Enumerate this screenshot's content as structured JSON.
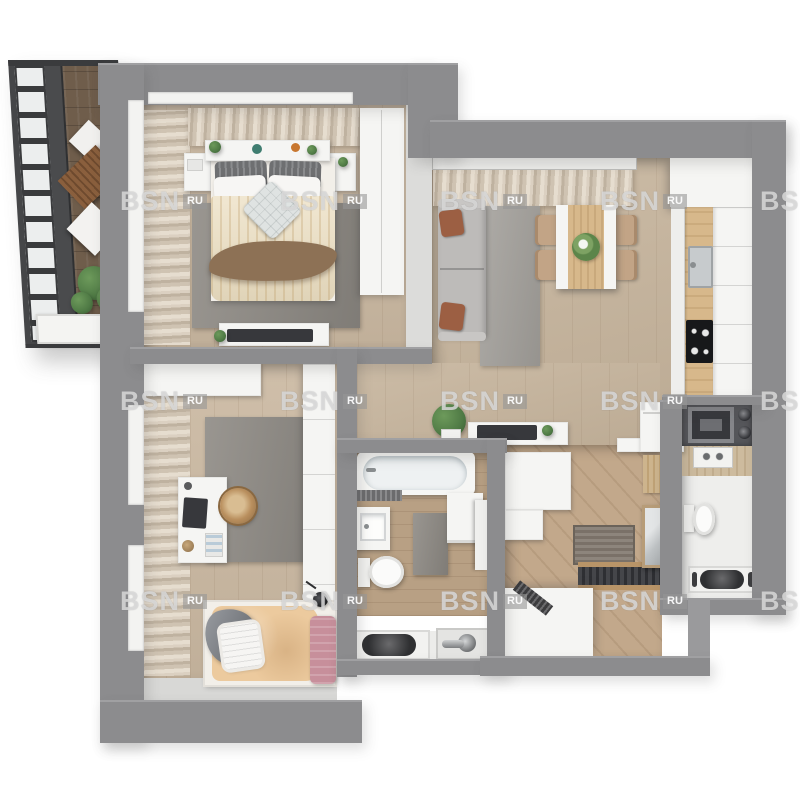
{
  "title": "apartment-3d-floor-plan-render",
  "watermark": {
    "brand": "BSN",
    "suffix": "RU",
    "columns_px": [
      120,
      280,
      440,
      600,
      760
    ],
    "rows_px": [
      188,
      388,
      588
    ]
  },
  "palette": {
    "wall": "#8c8c8e",
    "wallLight": "#a0a0a2",
    "dividerWhite": "#dcdcda",
    "balconyFrame": "#454648",
    "balconyDark": "#3a3b3d",
    "glass": "#eceeee",
    "deck": "#6f5d4b",
    "oakFloor": "#cbb9a2",
    "livingFloor": "#c6b49c",
    "hallFloor": "#c2a88b",
    "bathFloor": "#b8a084",
    "rug": "#8e8a84",
    "rugLight": "#a3a09b",
    "whiteFurn": "#f5f5f3",
    "counterWood": "#d7b88b",
    "darkCounter": "#55565a",
    "applianceDark": "#37383c",
    "sofa": "#bdbbb9",
    "accentRust": "#9c5f43",
    "chairTan": "#c2a486",
    "duvetCream": "#ecdfc2",
    "blanketBrown": "#8d7155",
    "kidsDuvet": "#ecca9e",
    "pinkBlanket": "#c78f9b",
    "plantGreen": "#4f7a45"
  },
  "rooms": [
    {
      "id": "balcony",
      "furniture": [
        "glazing",
        "wood-deck",
        "lounge-chair",
        "cushions",
        "plant",
        "planter-box"
      ]
    },
    {
      "id": "master-bedroom",
      "furniture": [
        "curtains",
        "headboard-shelf",
        "nightstands",
        "double-bed",
        "striped-pillows",
        "duvet",
        "throw-blanket",
        "area-rug",
        "wardrobe",
        "tv-stand",
        "tv"
      ]
    },
    {
      "id": "living-room-kitchen",
      "furniture": [
        "curtains",
        "sofa",
        "accent-pillows",
        "area-rug",
        "dining-table",
        "dining-chairs",
        "flower-bouquet",
        "upper-cabinets",
        "counter",
        "sink",
        "cooktop",
        "tall-cabinets"
      ]
    },
    {
      "id": "kids-bedroom",
      "furniture": [
        "curtains",
        "storage-cabinet",
        "area-rug",
        "desk",
        "laptop",
        "rattan-chair",
        "single-bed",
        "pillow",
        "duvet",
        "pink-blanket",
        "clothes",
        "wardrobe",
        "pendant-lamp"
      ]
    },
    {
      "id": "bathroom",
      "furniture": [
        "bathtub",
        "bath-mat",
        "washbasin",
        "toilet",
        "rug",
        "washing-machine",
        "door"
      ]
    },
    {
      "id": "hallway",
      "furniture": [
        "console-table",
        "decor-tray",
        "potted-plant",
        "built-in-cabinet",
        "doormat",
        "entry-mat",
        "storage-bench",
        "slat-rail",
        "shelf",
        "closet",
        "shoe-cabinet",
        "mirror"
      ]
    },
    {
      "id": "utility-room",
      "furniture": [
        "dark-counter",
        "microwave",
        "canisters",
        "sink-unit",
        "toilet",
        "laundry-unit"
      ]
    },
    {
      "id": "service-niche",
      "furniture": [
        "washer-unit",
        "pipes"
      ]
    }
  ]
}
